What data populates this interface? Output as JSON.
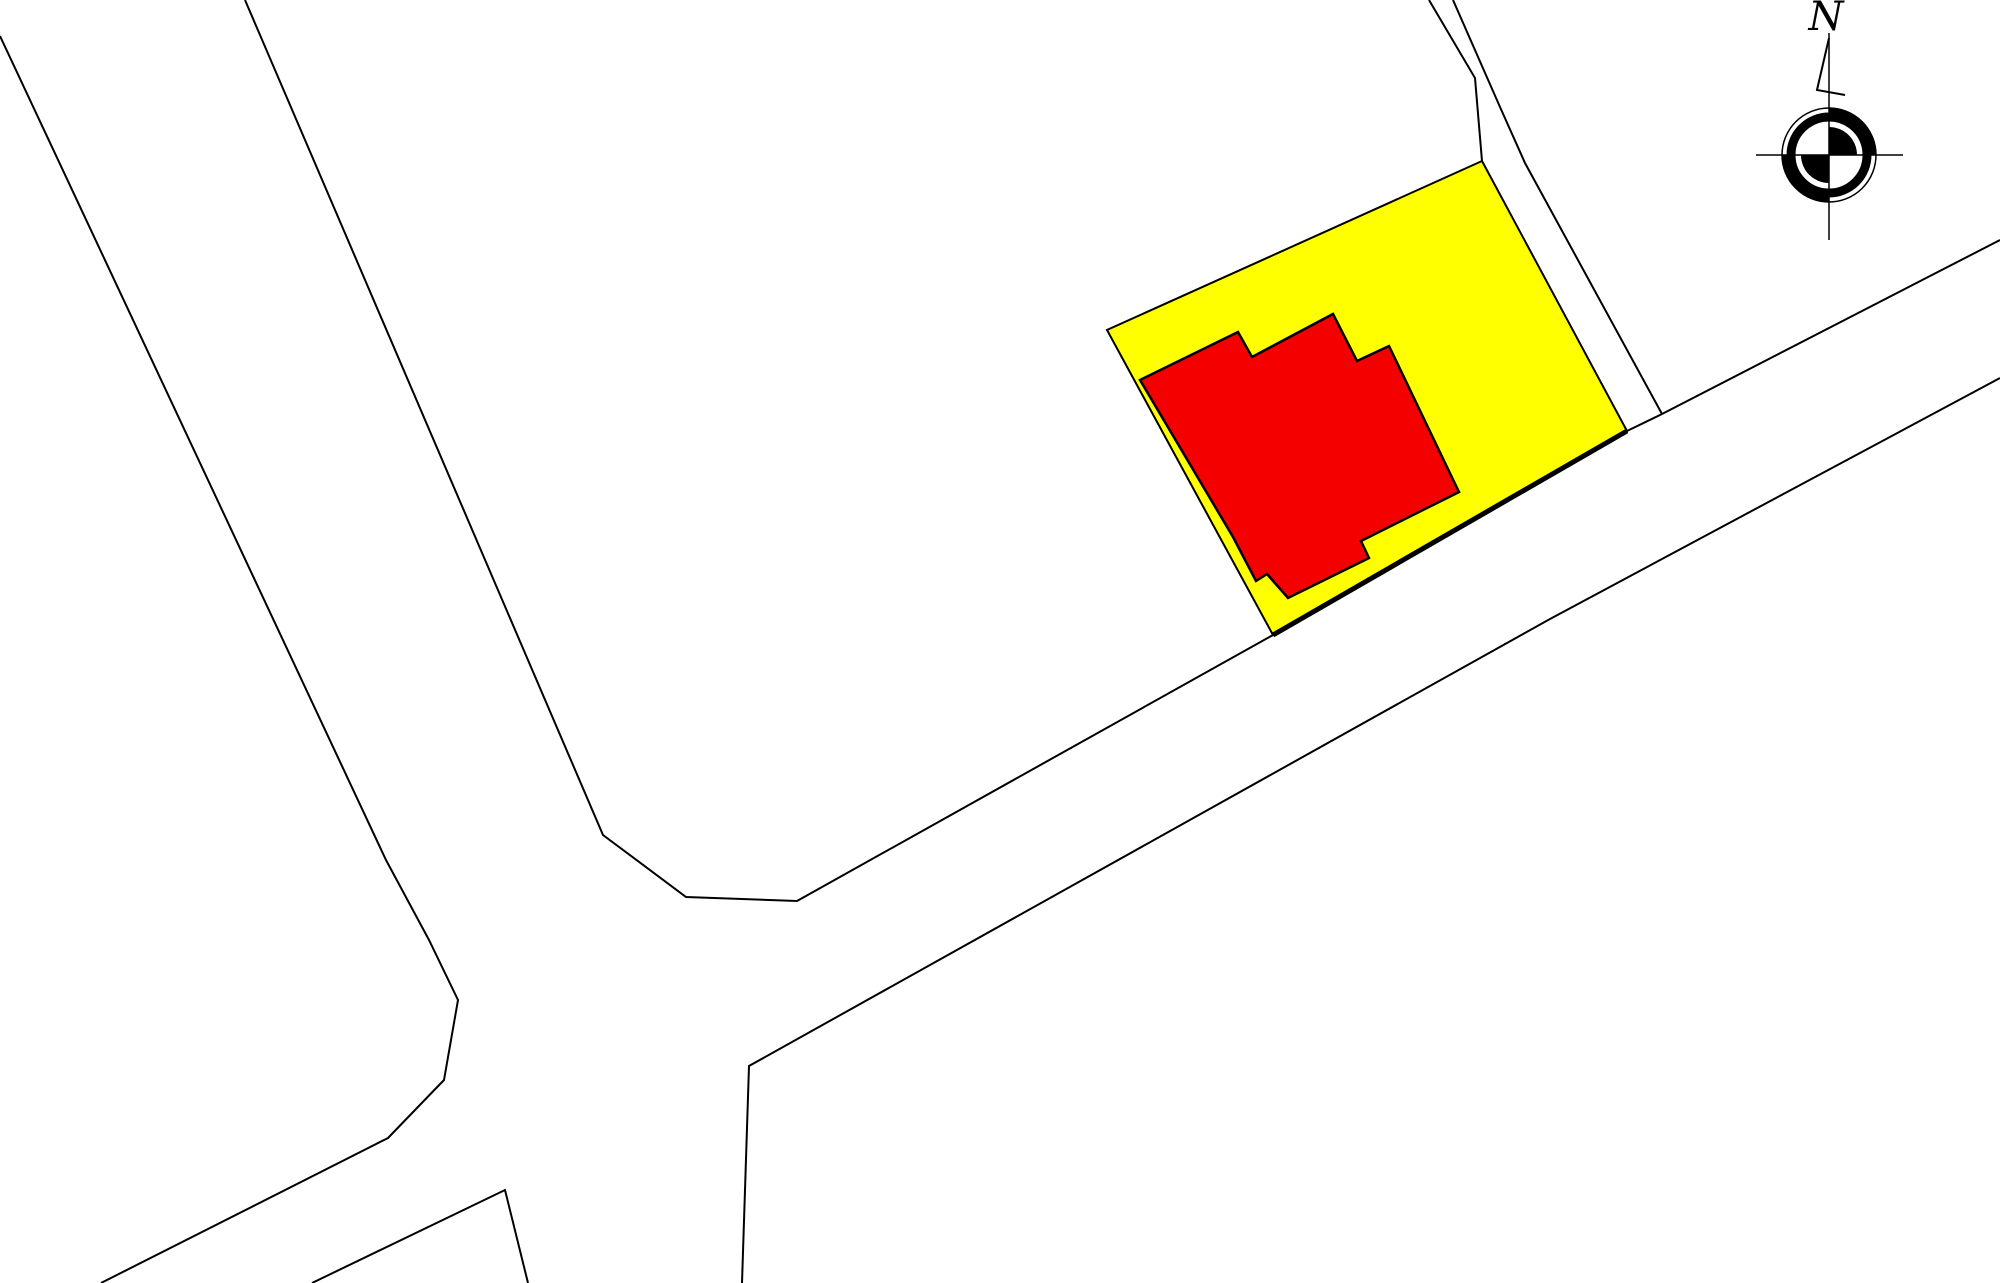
{
  "document": {
    "kind": "cadastral-site-plan",
    "background": "#ffffff",
    "line_color": "#000000",
    "width": 2000,
    "height": 1283
  },
  "legend_colors": {
    "parcel": "#ffff00",
    "building": "#f40000"
  },
  "compass": {
    "label": "N",
    "cx": 1829,
    "cy": 155,
    "outer_radius": 47,
    "ring_radius": 38,
    "ring_width": 9,
    "accent_arc_radius": 44.5,
    "accent_arc_width": 5,
    "inner_radius": 28,
    "vline": [
      1829,
      33,
      1829,
      240
    ],
    "hline": [
      1756,
      155,
      1903,
      155
    ],
    "flag": [
      [
        1829,
        38
      ],
      [
        1817,
        90
      ],
      [
        1845,
        95
      ]
    ],
    "label_x": 1826,
    "label_y": 30
  },
  "features": [
    {
      "name": "road-west-edge-and-sw-spur",
      "kind": "polyline",
      "stroke_width": 2,
      "points": [
        [
          0,
          36
        ],
        [
          386,
          860
        ],
        [
          429,
          940
        ],
        [
          458,
          1000
        ],
        [
          444,
          1080
        ],
        [
          388,
          1138
        ],
        [
          101,
          1283
        ]
      ]
    },
    {
      "name": "road-east-edge-and-main-road-north-edge",
      "kind": "polyline",
      "stroke_width": 2,
      "points": [
        [
          245,
          0
        ],
        [
          603,
          835
        ],
        [
          686,
          897
        ],
        [
          797,
          901
        ],
        [
          1273,
          635
        ],
        [
          1627,
          431
        ],
        [
          1662,
          414
        ],
        [
          2000,
          240
        ]
      ]
    },
    {
      "name": "main-road-south-edge",
      "kind": "polyline",
      "stroke_width": 2,
      "points": [
        [
          2000,
          378
        ],
        [
          1550,
          619
        ],
        [
          749,
          1066
        ],
        [
          742,
          1283
        ]
      ]
    },
    {
      "name": "side-lane-west-edge",
      "kind": "polyline",
      "stroke_width": 2,
      "points": [
        [
          1429,
          0
        ],
        [
          1475,
          78
        ],
        [
          1482,
          161
        ]
      ]
    },
    {
      "name": "side-lane-east-edge",
      "kind": "polyline",
      "stroke_width": 2,
      "points": [
        [
          1453,
          0
        ],
        [
          1500,
          107
        ],
        [
          1525,
          163
        ],
        [
          1662,
          414
        ]
      ]
    },
    {
      "name": "south-parcel-corner-peak",
      "kind": "polyline",
      "stroke_width": 2,
      "points": [
        [
          312,
          1283
        ],
        [
          505,
          1190
        ],
        [
          528,
          1283
        ]
      ]
    },
    {
      "name": "highlighted-parcel",
      "kind": "polygon",
      "fill": "parcel",
      "stroke_width": 2,
      "points": [
        [
          1482,
          161
        ],
        [
          1627,
          431
        ],
        [
          1273,
          635
        ],
        [
          1107,
          330
        ]
      ]
    },
    {
      "name": "parcel-road-frontage-thick-edge",
      "kind": "polyline",
      "stroke_width": 5,
      "points": [
        [
          1627,
          431
        ],
        [
          1273,
          635
        ]
      ]
    },
    {
      "name": "building-footprint",
      "kind": "polygon",
      "fill": "building",
      "stroke_width": 2.5,
      "points": [
        [
          1238,
          332
        ],
        [
          1252,
          357
        ],
        [
          1333,
          314
        ],
        [
          1357,
          361
        ],
        [
          1389,
          346
        ],
        [
          1459,
          492
        ],
        [
          1361,
          541
        ],
        [
          1369,
          558
        ],
        [
          1288,
          598
        ],
        [
          1267,
          574
        ],
        [
          1256,
          581
        ],
        [
          1233,
          537
        ],
        [
          1140,
          380
        ]
      ]
    }
  ]
}
